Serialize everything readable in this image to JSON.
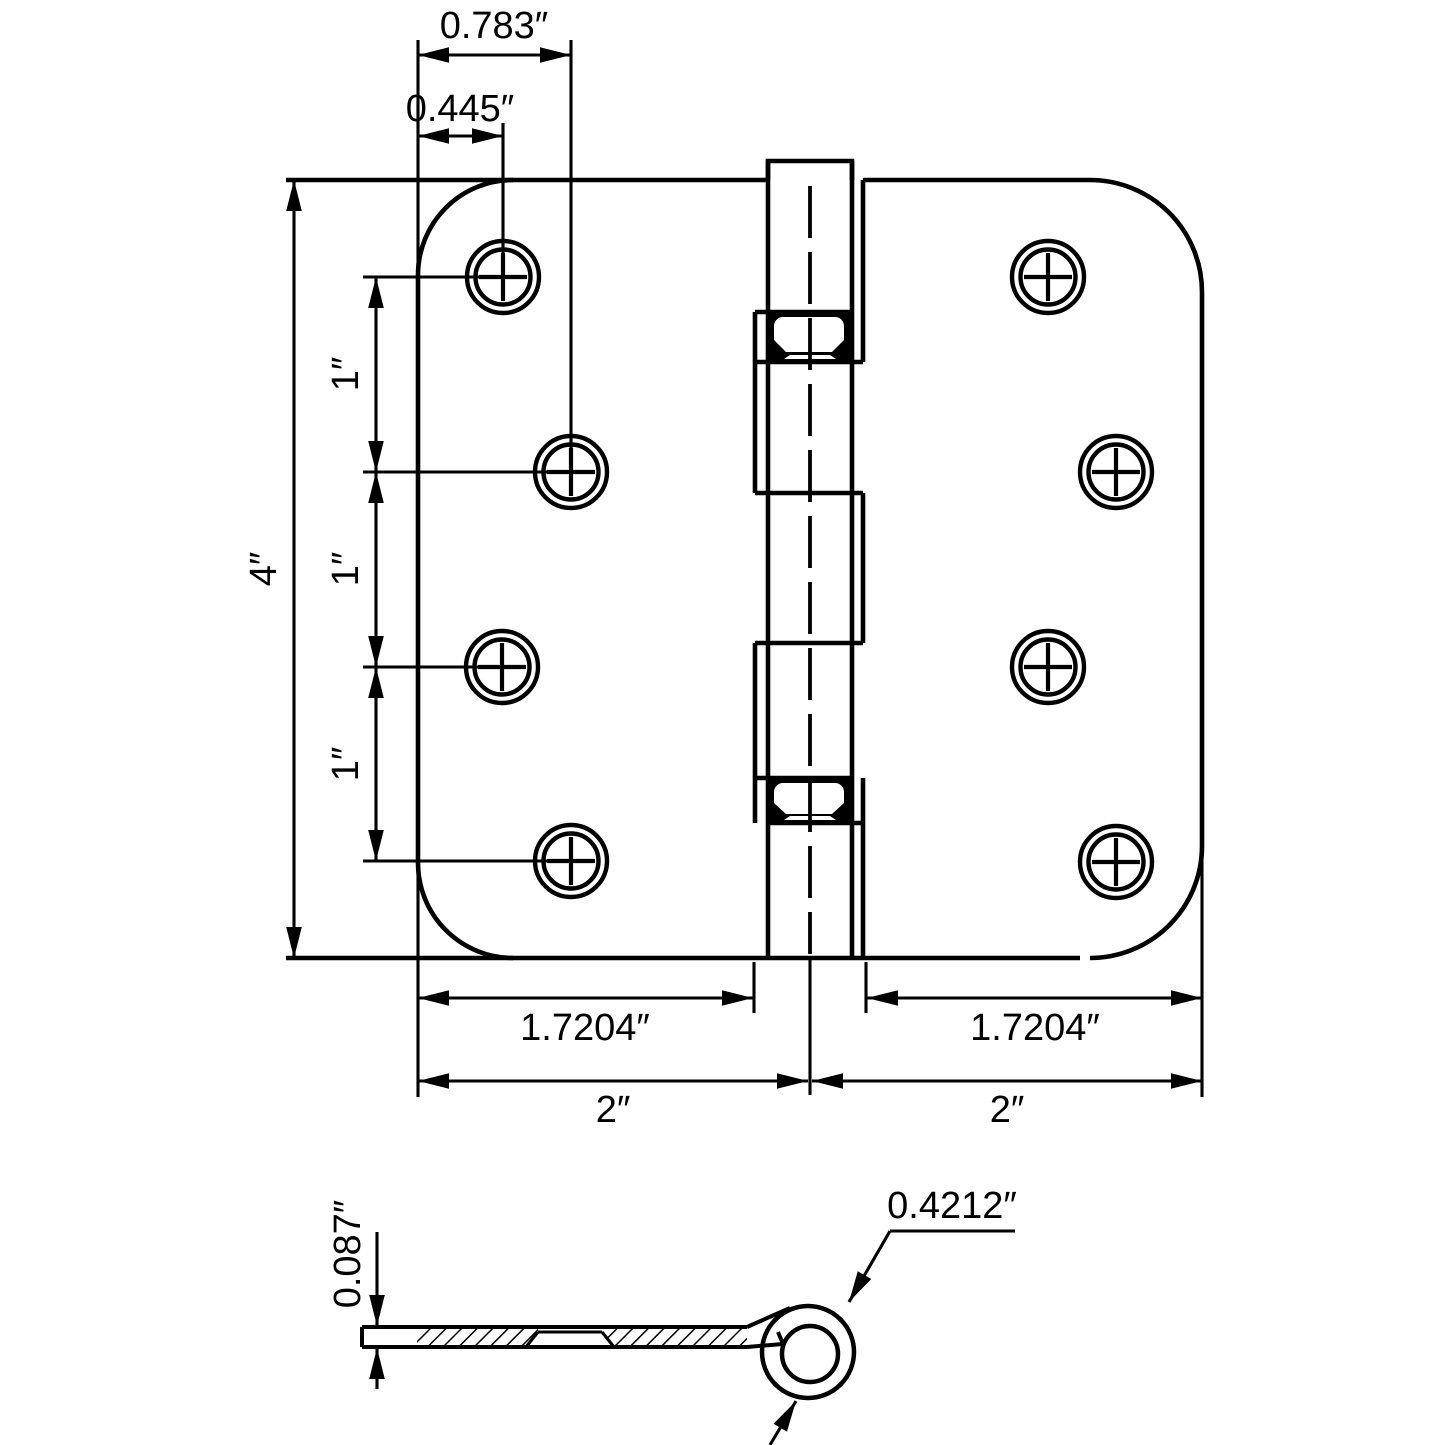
{
  "drawing": {
    "type": "technical-dimension-drawing",
    "subject": "door-hinge",
    "colors": {
      "line": "#000000",
      "background": "#ffffff"
    },
    "front_view": {
      "dims": {
        "hole_inset_outer": "0.783″",
        "hole_inset_inner": "0.445″",
        "leaf_height": "4″",
        "hole_pitch": [
          "1″",
          "1″",
          "1″"
        ],
        "flat_width_left": "1.7204″",
        "flat_width_right": "1.7204″",
        "leaf_width_left": "2″",
        "leaf_width_right": "2″"
      }
    },
    "side_view": {
      "dims": {
        "leaf_thickness": "0.087″",
        "knuckle_diameter": "0.4212″"
      }
    }
  }
}
